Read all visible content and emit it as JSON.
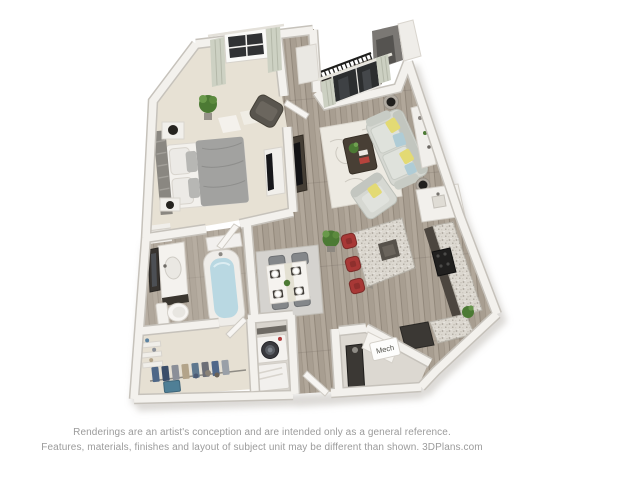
{
  "plan": {
    "mech_label": "Mech"
  },
  "footer": {
    "line1": "Renderings are an artist's conception and are intended only as a general reference.",
    "line2": "Features, materials, finishes and layout of subject unit may be different than shown. 3DPlans.com"
  },
  "colors": {
    "background": "#ffffff",
    "wall": "#f3f1ed",
    "wall_edge": "#c6c2bb",
    "dark_wall": "#7b7874",
    "wood_floor": "#b1a79a",
    "carpet": "#e7e1d4",
    "bath_floor": "#b6ada1",
    "closet_carpet": "#e6e0d3",
    "balcony_floor": "#6a6158",
    "granite": "#dcd8d0",
    "rug_living": "#edeae2",
    "rug_dining": "#d5d3cf",
    "sofa": "#d6d8d2",
    "pillow_yellow": "#e3da74",
    "pillow_blue": "#afccd6",
    "bed_duvet": "#a2a2a0",
    "stool_red": "#a83836",
    "tub_water": "#b9d8e2",
    "plant_green": "#4c7a34",
    "appliance_dark": "#3b3834",
    "footer_text": "#9b9b9b"
  }
}
